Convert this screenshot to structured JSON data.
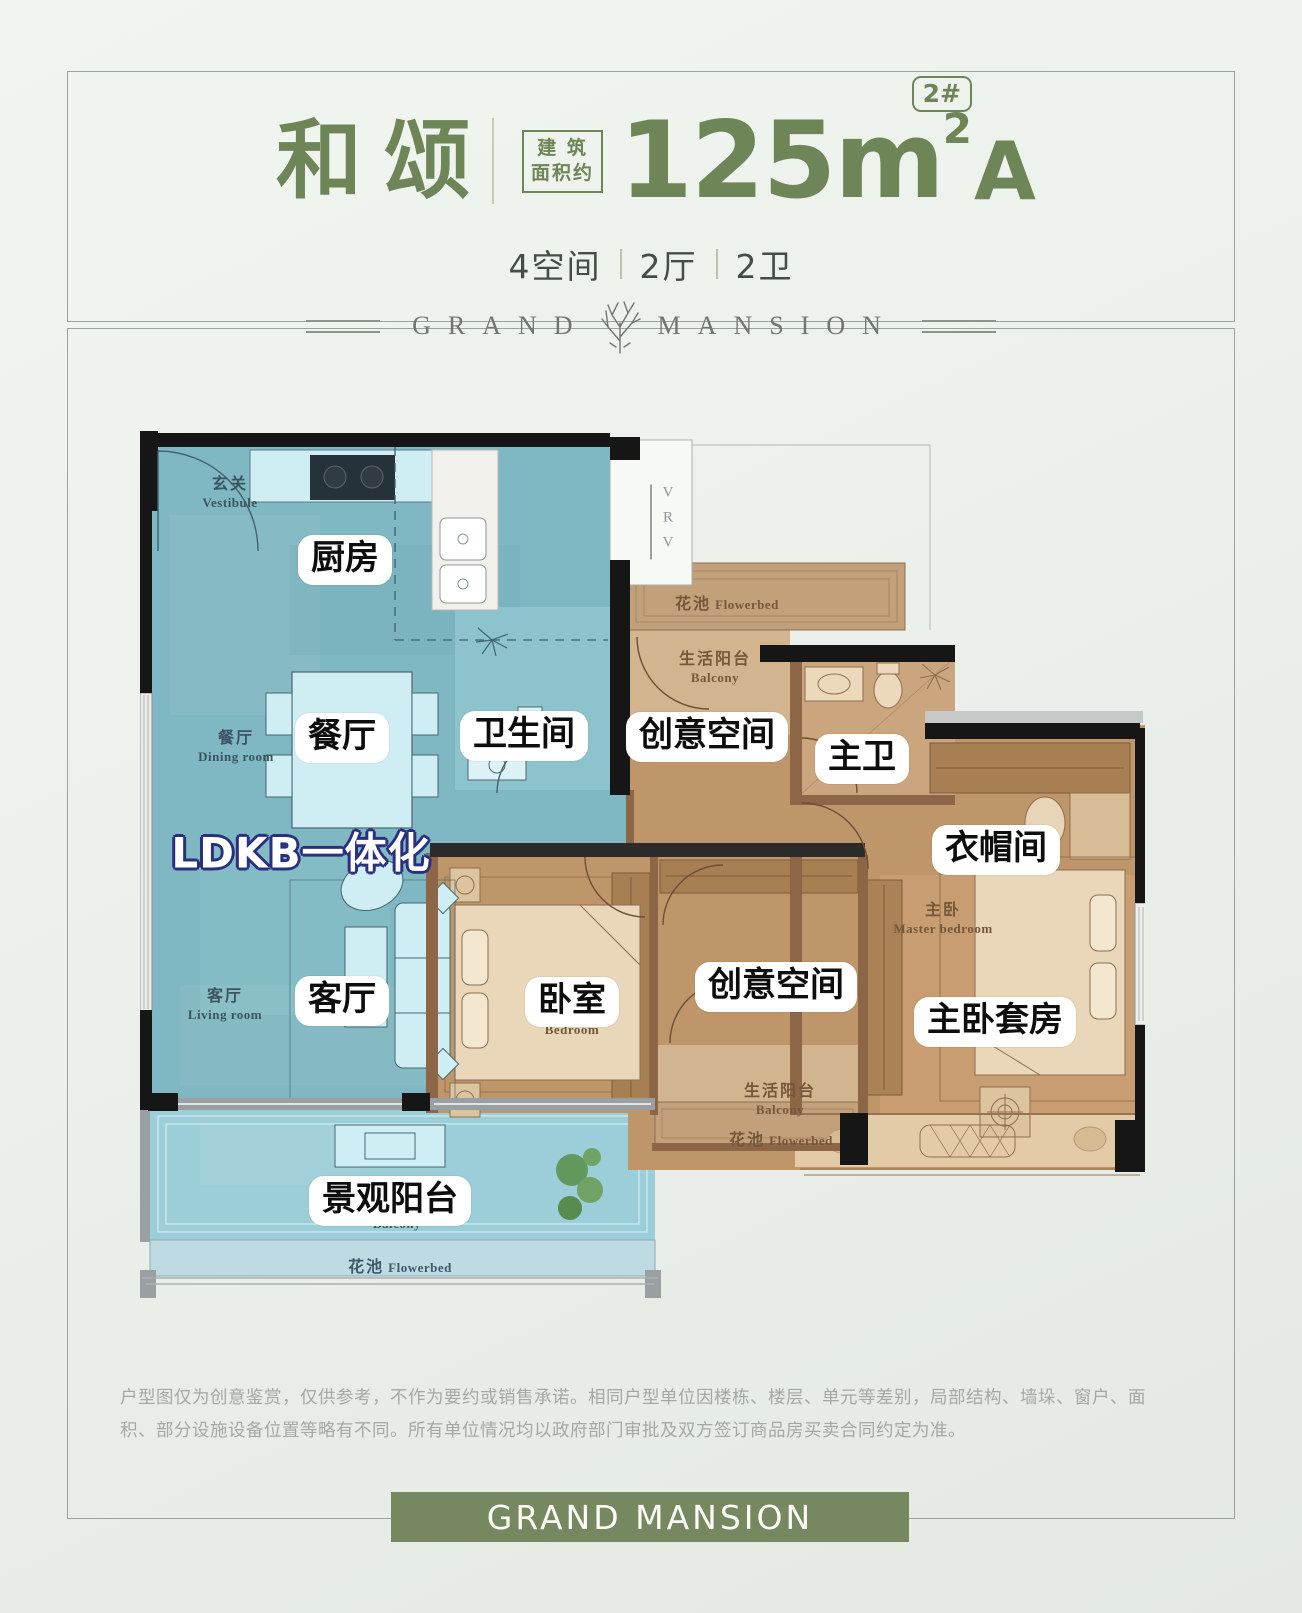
{
  "header": {
    "title": "和颂",
    "area_label_line1": "建 筑",
    "area_label_line2": "面积约",
    "area_number": "125m",
    "area_superscript": "2",
    "unit_type": "A",
    "building_badge": "2#",
    "specs": [
      {
        "label": "4空间"
      },
      {
        "label": "2厅"
      },
      {
        "label": "2卫"
      }
    ]
  },
  "brand": {
    "word_left": "GRAND",
    "word_right": "MANSION",
    "banner_text": "GRAND MANSION"
  },
  "floorplan": {
    "feature_label": "LDKB一体化",
    "vrv_label": "VRV",
    "room_labels": [
      {
        "text": "厨房"
      },
      {
        "text": "餐厅"
      },
      {
        "text": "卫生间"
      },
      {
        "text": "创意空间"
      },
      {
        "text": "主卫"
      },
      {
        "text": "衣帽间"
      },
      {
        "text": "客厅"
      },
      {
        "text": "卧室"
      },
      {
        "text": "创意空间"
      },
      {
        "text": "主卧套房"
      },
      {
        "text": "景观阳台"
      }
    ],
    "area_labels": {
      "vestibule": {
        "zh": "玄关",
        "en": "Vestibule"
      },
      "dining": {
        "zh": "餐厅",
        "en": "Dining room"
      },
      "living": {
        "zh": "客厅",
        "en": "Living room"
      },
      "flowerbed_top": {
        "zh": "花池",
        "en": "Flowerbed"
      },
      "balcony_top": {
        "zh": "生活阳台",
        "en": "Balcony"
      },
      "master": {
        "zh": "主卧",
        "en": "Master bedroom"
      },
      "bedroom": {
        "en": "Bedroom"
      },
      "balcony_bottom": {
        "zh": "生活阳台",
        "en": "Balcony"
      },
      "flowerbed_mid": {
        "zh": "花池",
        "en": "Flowerbed"
      },
      "scenic_balcony_en": {
        "en": "Balcony"
      },
      "flowerbed_bottom": {
        "zh": "花池",
        "en": "Flowerbed"
      }
    }
  },
  "disclaimer": "户型图仅为创意鉴赏，仅供参考，不作为要约或销售承诺。相同户型单位因楼栋、楼层、单元等差别，局部结构、墙垛、窗户、面积、部分设施设备位置等略有不同。所有单位情况均以政府部门审批及双方签订商品房买卖合同约定为准。",
  "colors": {
    "accent_green": "#6e8557",
    "banner_green": "#76885f",
    "ldk_teal": "#7fb7c2",
    "wood_brown": "#bf956a",
    "balcony_blue": "#9cced9",
    "label_outline_navy": "#2a2f7e",
    "wall_black": "#161616"
  }
}
